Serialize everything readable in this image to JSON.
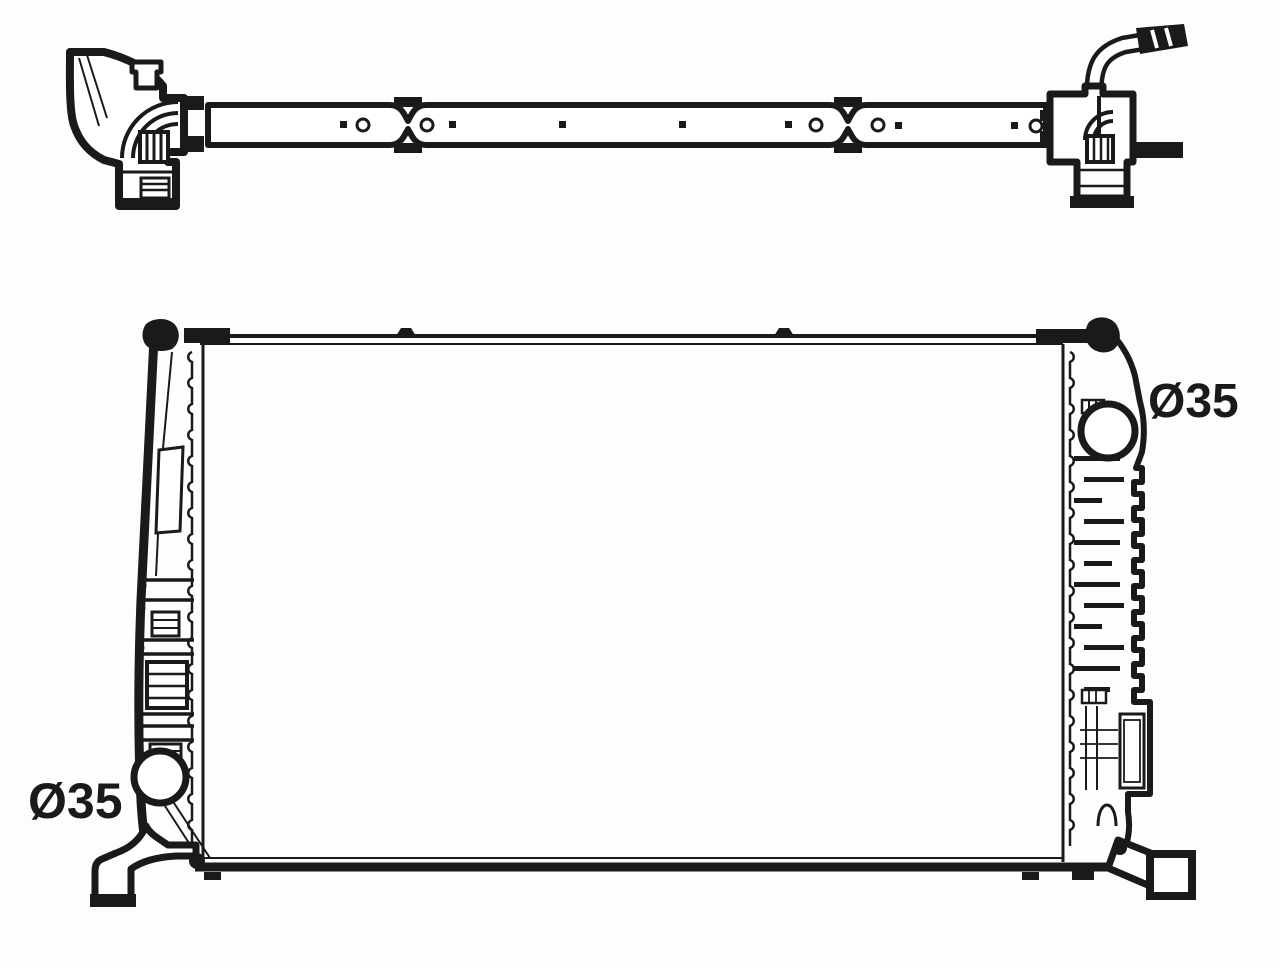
{
  "canvas": {
    "width": 1280,
    "height": 968,
    "background": "#fdfdfd",
    "line_color": "#1a1a1a"
  },
  "figure": {
    "type": "technical-line-drawing",
    "views": [
      "top-profile-view",
      "front-view"
    ]
  },
  "annotations": {
    "top_right_port": {
      "text": "Ø35"
    },
    "bottom_left_port": {
      "text": "Ø35"
    }
  }
}
